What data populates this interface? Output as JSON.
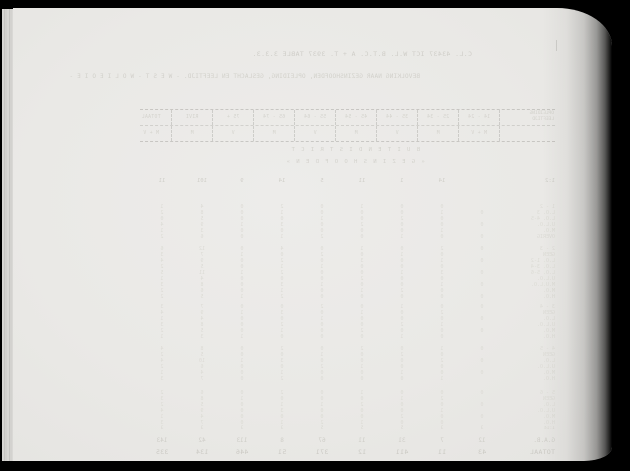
{
  "colors": {
    "paper": "#eae9e6",
    "scanner_background": "#000000",
    "faint_ink": "#d6d5cf"
  },
  "bleed": {
    "title_line": "C.L. 43437 ICT  W.L. B.T.C.  A + T. 3937     TABLE 3.3.3.",
    "subject_line": "BEVOLKING NAAR GEZINSHOOFDEN, OPLEIDING, GESLACHT EN LEEFTIJD.  - W E S T -  W O L I E O I E -",
    "center_line_1": "B U I T E N D I S T R I C T",
    "center_line_2": "«  G E Z I N S H O O F D E N  »",
    "table": {
      "stub": [
        "OPLEIDING",
        "LEEFTIJD"
      ],
      "columns": [
        "14 - 24",
        "25 - 34",
        "35 - 44",
        "45 - 54",
        "55 - 64",
        "65 - 74",
        "75 +",
        "RIVI",
        "TOTAAL"
      ],
      "subheader": [
        "M + V",
        "M",
        "V",
        "M",
        "V",
        "M",
        "V",
        "M",
        "M + V"
      ],
      "summary_row": {
        "label": "1:2",
        "values": [
          "",
          "14",
          "1",
          "11",
          "5",
          "14",
          "9",
          "101",
          "11"
        ]
      },
      "groups": [
        {
          "label_lines": [
            "1 - 2",
            "L.O. 3",
            "L.O. 4-5",
            "U.L.O.",
            "M.O.",
            "OVERIG"
          ],
          "rows": [
            [
              "",
              "0",
              "0",
              "1",
              "0",
              "2",
              "0",
              "4",
              "1"
            ],
            [
              "0",
              "1",
              "0",
              "0",
              "0",
              "1",
              "0",
              "8",
              "2"
            ],
            [
              "",
              "0",
              "2",
              "0",
              "1",
              "0",
              "0",
              "5",
              "0"
            ],
            [
              "0",
              "0",
              "0",
              "2",
              "0",
              "3",
              "1",
              "9",
              "4"
            ],
            [
              "",
              "1",
              "0",
              "0",
              "0",
              "0",
              "0",
              "3",
              "1"
            ],
            [
              "0",
              "0",
              "1",
              "0",
              "2",
              "1",
              "0",
              "6",
              "2"
            ]
          ]
        },
        {
          "label_lines": [
            "2 - 3",
            "GEEN",
            "L.O. 1-2",
            "L.O. 3-4",
            "L.O. 5-6",
            "U.L.O.",
            "M.U.L.O.",
            "M.O.",
            "H.O."
          ],
          "rows": [
            [
              "0",
              "2",
              "0",
              "1",
              "0",
              "4",
              "0",
              "12",
              "6"
            ],
            [
              "",
              "0",
              "1",
              "0",
              "2",
              "0",
              "1",
              "7",
              "3"
            ],
            [
              "0",
              "1",
              "0",
              "3",
              "0",
              "2",
              "0",
              "9",
              "4"
            ],
            [
              "",
              "0",
              "0",
              "0",
              "1",
              "1",
              "0",
              "5",
              "2"
            ],
            [
              "0",
              "3",
              "1",
              "0",
              "0",
              "2",
              "1",
              "11",
              "5"
            ],
            [
              "",
              "0",
              "0",
              "2",
              "0",
              "0",
              "0",
              "4",
              "1"
            ],
            [
              "0",
              "1",
              "0",
              "0",
              "1",
              "3",
              "0",
              "8",
              "3"
            ],
            [
              "",
              "0",
              "2",
              "1",
              "0",
              "1",
              "0",
              "6",
              "2"
            ],
            [
              "0",
              "0",
              "0",
              "0",
              "0",
              "2",
              "1",
              "5",
              "2"
            ]
          ]
        },
        {
          "label_lines": [
            "3 - 4",
            "GEEN",
            "L.O.",
            "U.L.O.",
            "M.O.",
            "H.O."
          ],
          "rows": [
            [
              "0",
              "0",
              "1",
              "0",
              "2",
              "0",
              "0",
              "7",
              "3"
            ],
            [
              "",
              "2",
              "0",
              "1",
              "0",
              "3",
              "1",
              "9",
              "4"
            ],
            [
              "0",
              "0",
              "0",
              "0",
              "1",
              "0",
              "0",
              "4",
              "1"
            ],
            [
              "",
              "1",
              "2",
              "0",
              "0",
              "2",
              "0",
              "8",
              "3"
            ],
            [
              "0",
              "0",
              "0",
              "2",
              "0",
              "1",
              "0",
              "5",
              "2"
            ],
            [
              "",
              "0",
              "1",
              "0",
              "0",
              "0",
              "1",
              "3",
              "1"
            ]
          ]
        },
        {
          "label_lines": [
            "4 - 5",
            "GEEN",
            "L.O.",
            "U.L.O.",
            "M.O.",
            "H.O."
          ],
          "rows": [
            [
              "0",
              "1",
              "0",
              "2",
              "0",
              "2",
              "0",
              "8",
              "4"
            ],
            [
              "",
              "0",
              "2",
              "0",
              "1",
              "0",
              "0",
              "5",
              "2"
            ],
            [
              "0",
              "2",
              "0",
              "0",
              "0",
              "3",
              "1",
              "10",
              "4"
            ],
            [
              "",
              "0",
              "0",
              "1",
              "2",
              "0",
              "0",
              "6",
              "2"
            ],
            [
              "0",
              "0",
              "1",
              "0",
              "0",
              "1",
              "0",
              "4",
              "1"
            ],
            [
              "",
              "1",
              "0",
              "0",
              "0",
              "2",
              "0",
              "7",
              "3"
            ]
          ]
        },
        {
          "label_lines": [
            "5 - 6",
            "GEEN",
            "L.O.",
            "U.L.O.",
            "M.O.",
            "H.O."
          ],
          "rows": [
            [
              "0",
              "0",
              "0",
              "1",
              "0",
              "2",
              "0",
              "6",
              "2"
            ],
            [
              "",
              "2",
              "1",
              "0",
              "0",
              "0",
              "1",
              "8",
              "3"
            ],
            [
              "0",
              "0",
              "0",
              "2",
              "1",
              "1",
              "0",
              "5",
              "2"
            ],
            [
              "",
              "1",
              "0",
              "0",
              "0",
              "3",
              "0",
              "9",
              "4"
            ],
            [
              "0",
              "0",
              "2",
              "0",
              "0",
              "0",
              "0",
              "4",
              "1"
            ],
            [
              "",
              "0",
              "0",
              "1",
              "2",
              "1",
              "0",
              "7",
              "3"
            ]
          ]
        }
      ],
      "footer_rows": [
        {
          "label": "1:14",
          "values": [
            "3",
            "3",
            "5",
            "5",
            "5",
            "3",
            "3",
            "3",
            "3"
          ]
        },
        {
          "label": "G.A.B.",
          "values": [
            "12",
            "7",
            "31",
            "11",
            "67",
            "8",
            "113",
            "42",
            "143"
          ]
        },
        {
          "label": "TOTAAL",
          "values": [
            "43",
            "11",
            "411",
            "12",
            "371",
            "51",
            "446",
            "134",
            "335"
          ]
        }
      ]
    }
  }
}
